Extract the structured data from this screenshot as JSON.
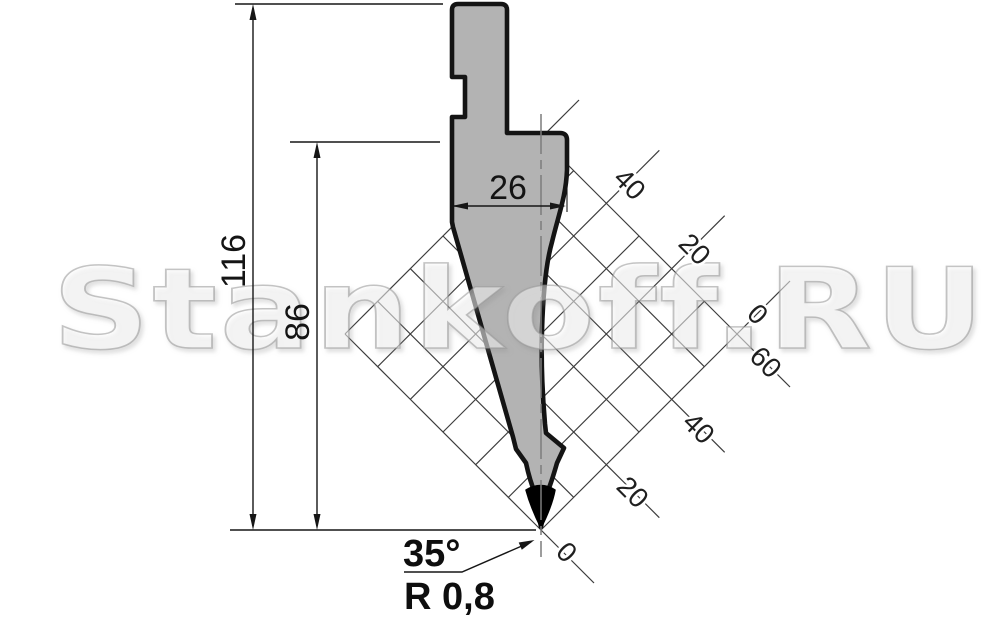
{
  "drawing": {
    "title": "press-brake-punch-profile",
    "watermark": "Stankoff.RU",
    "dimensions": {
      "total_height": "116",
      "shoulder_height": "86",
      "body_width": "26",
      "tip_angle": "35°",
      "tip_radius": "R 0,8"
    },
    "ruler": {
      "upper_labels": [
        "40",
        "20",
        "0"
      ],
      "lower_labels": [
        "60",
        "40",
        "20",
        "0"
      ]
    },
    "colors": {
      "punch_fill": "#b3b3b3",
      "punch_outline": "#141414",
      "tip_fill": "#000000",
      "grid_line": "#3c3c3c",
      "dimension_line": "#161616",
      "centerline": "#7d7d7d"
    }
  }
}
